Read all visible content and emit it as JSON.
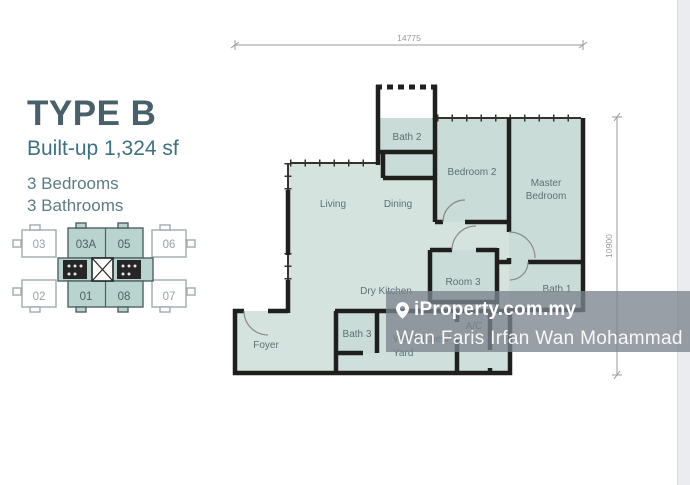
{
  "panel": {
    "title": "TYPE B",
    "builtup": "Built-up 1,324 sf",
    "bedrooms": "3 Bedrooms",
    "bathrooms": "3 Bathrooms"
  },
  "keyplan": {
    "top_row": [
      "03",
      "03A",
      "05",
      "06"
    ],
    "bottom_row": [
      "02",
      "01",
      "08",
      "07"
    ],
    "highlighted_units": [
      "03A",
      "05",
      "01",
      "08"
    ]
  },
  "floorplan": {
    "dim_top": "14775",
    "dim_right": "10900",
    "labels": {
      "living": "Living",
      "dining": "Dining",
      "bath2": "Bath 2",
      "bedroom2": "Bedroom 2",
      "master1": "Master",
      "master2": "Bedroom",
      "room3": "Room 3",
      "dry_kitchen": "Dry Kitchen",
      "bath1": "Bath 1",
      "bath3": "Bath 3",
      "wet_kitchen": "Wet Kitchen/",
      "yard": "Yard",
      "ac": "A/C",
      "foyer": "Foyer"
    }
  },
  "watermark": {
    "brand": "iProperty.com.my",
    "agent": "Wan Faris Irfan Wan Mohammad"
  },
  "colors": {
    "room_fill": "#d5e3df",
    "room_fill_dark": "#c9dcd8",
    "wall": "#1f1f1d",
    "keyplan_teal": "#b9d3cf",
    "title_text": "#47606a",
    "subtitle_text": "#3c7280",
    "watermark_bg": "rgba(123,132,141,0.78)"
  }
}
